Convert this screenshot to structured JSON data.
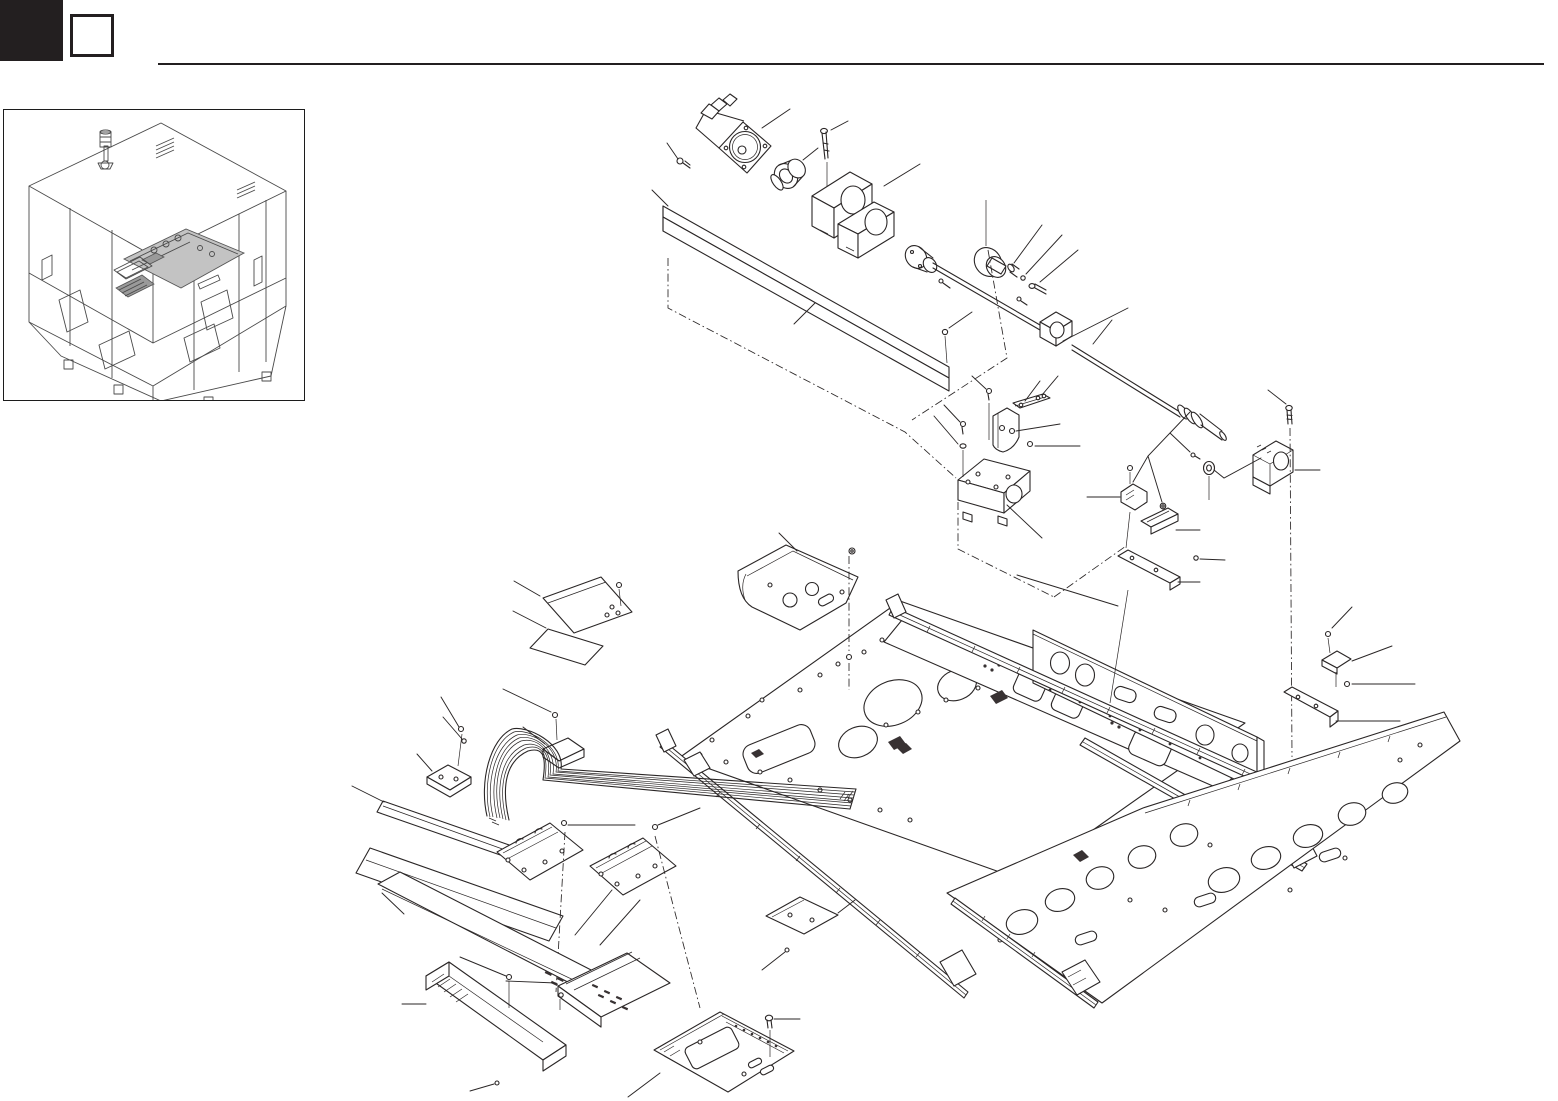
{
  "page": {
    "kind": "parts-catalog-exploded-view",
    "background_color": "#ffffff",
    "line_color": "#231f20",
    "visible_text": "",
    "part_labels_visible": false
  },
  "header": {
    "chapter_block": {
      "label": "",
      "style": "solid-black-square"
    },
    "section_box": {
      "label": "",
      "style": "empty-outlined-square"
    },
    "rule": {
      "present": true
    }
  },
  "overview_inset": {
    "aria": "isometric overview of machine with highlighted axis unit",
    "highlight_color": "#c3c3c3",
    "elements": [
      "machine-cabinet",
      "signal-tower-icon",
      "highlighted-module",
      "vent-grille",
      "door-panels",
      "feet"
    ]
  },
  "exploded_view": {
    "aria": "exploded view of axis drive unit with leader lines",
    "annotation_style": {
      "leader_lines": true,
      "center_lines": "dash-dot",
      "balloons": false
    },
    "parts": [
      {
        "name": "servo-motor"
      },
      {
        "name": "flange-screw"
      },
      {
        "name": "shaft-coupling"
      },
      {
        "name": "mounting-bolt"
      },
      {
        "name": "bearing-housing"
      },
      {
        "name": "frame-beam"
      },
      {
        "name": "beam-screw"
      },
      {
        "name": "ball-screw-nut"
      },
      {
        "name": "ball-screw-shaft"
      },
      {
        "name": "shaft-collar"
      },
      {
        "name": "dowel-pin"
      },
      {
        "name": "set-screw"
      },
      {
        "name": "collar-bolt"
      },
      {
        "name": "mid-support-clamp"
      },
      {
        "name": "end-bolt"
      },
      {
        "name": "end-support-block"
      },
      {
        "name": "washer"
      },
      {
        "name": "tip-screw"
      },
      {
        "name": "motor-mount-block"
      },
      {
        "name": "l-bracket"
      },
      {
        "name": "sensor-strip-top"
      },
      {
        "name": "sensor-clip"
      },
      {
        "name": "sensor-dog"
      },
      {
        "name": "sensor-base-strip"
      },
      {
        "name": "u-shaped-cover"
      },
      {
        "name": "cover-plate-small"
      },
      {
        "name": "gasket-pad"
      },
      {
        "name": "flat-flex-cable"
      },
      {
        "name": "cable-clamp-top"
      },
      {
        "name": "cable-bracket-left"
      },
      {
        "name": "cover-strip-short"
      },
      {
        "name": "cover-strip-long"
      },
      {
        "name": "cable-clamp-plate-a"
      },
      {
        "name": "cable-clamp-plate-b"
      },
      {
        "name": "upper-base-plate"
      },
      {
        "name": "linear-guide-rail-top"
      },
      {
        "name": "side-frame-plate"
      },
      {
        "name": "carriage-plate"
      },
      {
        "name": "linear-guide-rail-mid"
      },
      {
        "name": "lower-base-plate"
      },
      {
        "name": "linear-guide-rail-lower"
      },
      {
        "name": "rail-sensor-clip-right"
      },
      {
        "name": "rail-sensor-strip-right"
      },
      {
        "name": "corrugated-cover"
      },
      {
        "name": "cable-duct"
      },
      {
        "name": "perforated-channel"
      },
      {
        "name": "bottom-bracket-plate"
      },
      {
        "name": "small-plate-mid"
      }
    ]
  }
}
